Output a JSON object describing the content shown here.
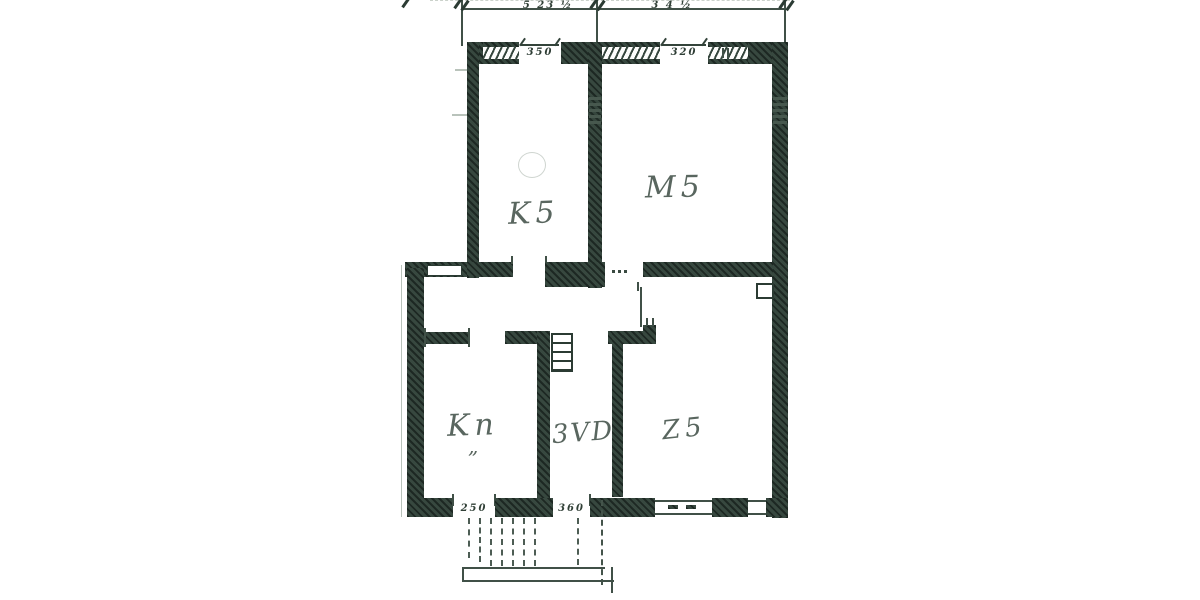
{
  "scan": {
    "paper_color": "#ffffff",
    "ink_color": "#2b3b33",
    "pencil_color": "#4c5a52"
  },
  "room_labels": {
    "top_left": "K5",
    "top_right": "M5",
    "bottom_left": "Kn",
    "bottom_left_marks": "„",
    "bottom_middle": "3VD",
    "bottom_right": "Z5"
  },
  "dimension_labels": {
    "top_span_left": "5 23 ½",
    "top_span_right": "3 4 ½",
    "window_top_left": "350",
    "window_top_right": "320",
    "door_bottom_left": "250",
    "door_bottom_middle": "360"
  }
}
